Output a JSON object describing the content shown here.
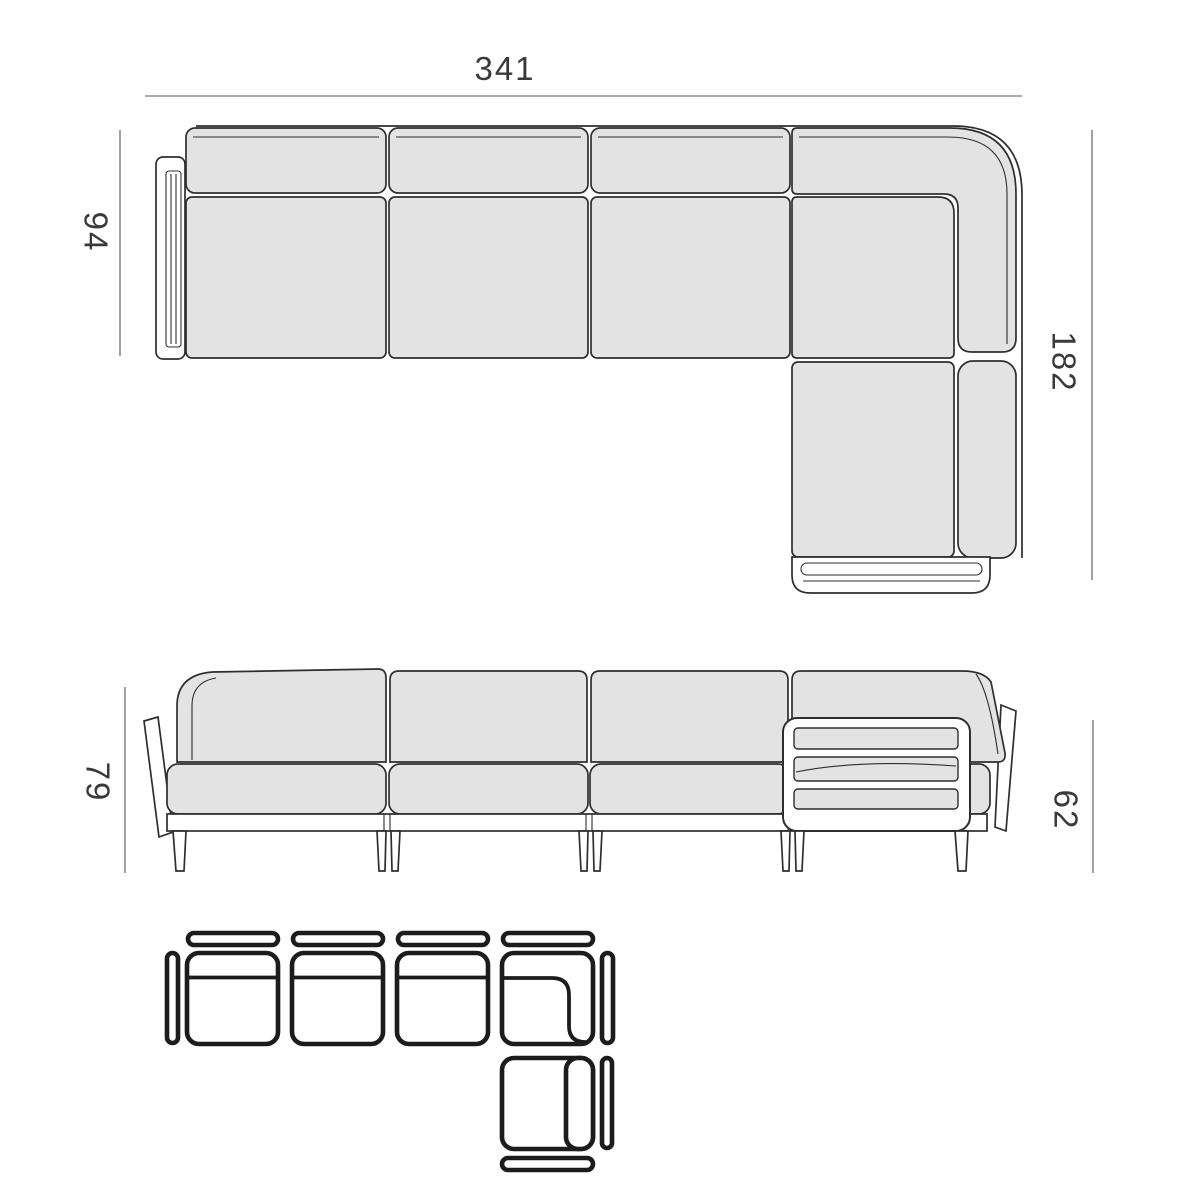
{
  "page": {
    "background": "#ffffff",
    "drawing_type": "furniture dimension diagram",
    "subject": "modular corner sofa with chaise"
  },
  "style": {
    "outline_color": "#2e2e2e",
    "cushion_fill": "#e3e3e3",
    "schematic_stroke": "#1c1c1c",
    "dimension_line_color": "#555555",
    "dimension_text_color": "#3a3a3a"
  },
  "top_view": {
    "name": "top view plan",
    "dims": {
      "total_width": "341",
      "sofa_depth": "94",
      "chaise_depth": "182"
    }
  },
  "front_view": {
    "name": "front view elevation",
    "dims": {
      "back_height": "79",
      "arm_height": "62"
    }
  },
  "schematic": {
    "name": "module configuration schematic",
    "modules": [
      {
        "icon": "armless-module-icon"
      },
      {
        "icon": "armless-module-icon"
      },
      {
        "icon": "armless-module-icon"
      },
      {
        "icon": "corner-module-icon"
      },
      {
        "icon": "end-module-icon"
      }
    ],
    "accessories": [
      {
        "icon": "back-panel-icon",
        "count": 4
      },
      {
        "icon": "side-panel-icon",
        "count": 4
      }
    ]
  }
}
